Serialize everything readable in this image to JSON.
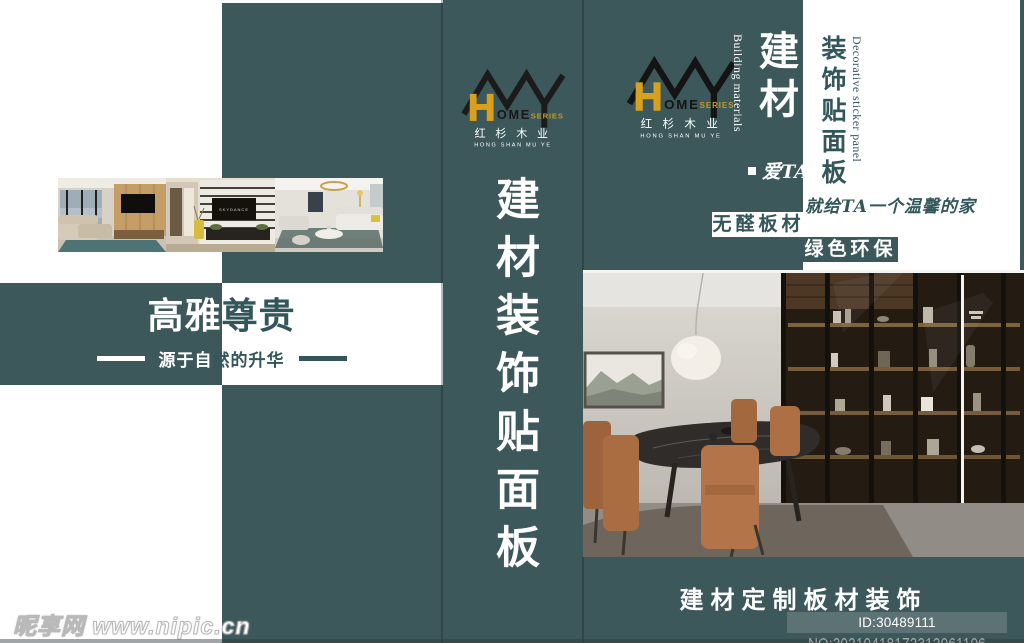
{
  "colors": {
    "teal": "#3c585b",
    "text_teal": "#33565a",
    "gold": "#d7a11d",
    "id_box_bg": "#5d7274"
  },
  "brand": {
    "logo_h": "H",
    "logo_ome": "OME",
    "logo_series": "SERIES",
    "name_cn": "红 杉 木 业",
    "name_en": "HONG SHAN MU YE"
  },
  "left_panel": {
    "headline_left": "高雅",
    "headline_right": "尊贵",
    "subline_left": "源于自",
    "subline_right": "然的升华"
  },
  "middle_panel": {
    "vertical_title": "建材装饰贴面板"
  },
  "right_panel": {
    "building_materials_en": "Building materials",
    "title_cn": "建材",
    "subtitle_cn": "装饰贴面板",
    "subtitle_en": "Decorative sticker panel",
    "love_ta": "爱TA",
    "slogan": "就给TA一个温馨的家",
    "badge_formaldehyde_free": "无醛板材",
    "badge_green": "绿色环保",
    "caption": "建材定制板材装饰"
  },
  "photo_strip": {
    "tv_brand": "SKYDANCE"
  },
  "watermark": {
    "site": "昵享网 www.nipic.cn",
    "image_id": "ID:30489111 NO:20210418172312061106"
  }
}
